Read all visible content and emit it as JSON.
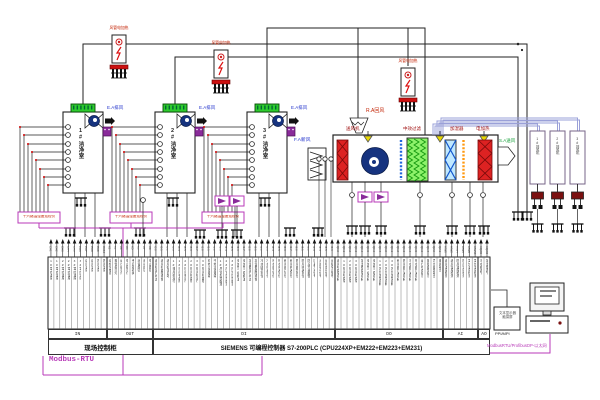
{
  "diagram": {
    "cleanrooms": [
      {
        "name": "1#洁净室",
        "exhaust_label": "E.A排风"
      },
      {
        "name": "2#洁净室",
        "exhaust_label": "E.A排风"
      },
      {
        "name": "3#洁净室",
        "exhaust_label": "E.A排风"
      }
    ],
    "duct_heaters": {
      "label": "风管电加热"
    },
    "ahu": {
      "return_air": "R.A回风",
      "fresh_air": "F.A新风",
      "supply_fan": "送风机",
      "filter": "中效过滤",
      "humidifier": "加湿器",
      "electric_heater": "电加热",
      "supply_air": "S.A送风"
    },
    "exhaust_fans": [
      {
        "name": "1#排风机"
      },
      {
        "name": "2#排风机"
      },
      {
        "name": "3#排风机"
      }
    ],
    "monitors": {
      "label": "十六路温湿度巡检仪"
    },
    "hmi": {
      "line1": "文本显示器",
      "line2": "触摸屏",
      "port_label": "PPI/MPI"
    },
    "buses": {
      "modbus": "Modbus-RTU",
      "ethernet": "ModbusRTU/ProfibusDP-以太网"
    },
    "plc": {
      "cabinet": "现场控制柜",
      "controller": "SIEMENS   可编程控制器 S7-200PLC (CPU224XP+EM222+EM223+EM231)"
    },
    "io_sections": [
      {
        "label": "IN",
        "codes": [
          "CH1",
          "CH2",
          "CH3",
          "CH4",
          "CH5",
          "CH6",
          "CH7",
          "CH8",
          "CH9",
          "CH10"
        ],
        "signals": [
          "1#室内温度",
          "1#室内湿度",
          "2#室内温度",
          "2#室内湿度",
          "3#室内温度",
          "3#室内湿度",
          "送风温度",
          "送风湿度",
          "回风温度",
          "回风湿度"
        ]
      },
      {
        "label": "OUT",
        "codes": [
          "K1",
          "K2",
          "K3",
          "K4",
          "K5",
          "K6",
          "K7",
          "K8"
        ],
        "signals": [
          "巡检仪电源",
          "报警指示灯",
          "运行指示灯",
          "停止指示灯",
          "手自动转换",
          "消音按钮",
          "启动按钮",
          "停止按钮"
        ]
      },
      {
        "label": "DI",
        "codes": [
          "I0.0",
          "I0.1",
          "I0.2",
          "I0.3",
          "I0.4",
          "I0.5",
          "I0.6",
          "I0.7",
          "I1.0",
          "I1.1",
          "I1.2",
          "I1.3",
          "I1.4",
          "I1.5",
          "I1.6",
          "I1.7",
          "I2.0",
          "I2.1",
          "I2.2",
          "I2.3",
          "I2.4",
          "I2.5",
          "I2.6",
          "I2.7",
          "I3.0",
          "I3.1",
          "I3.2",
          "I3.3",
          "I3.4",
          "I3.5",
          "I3.6"
        ],
        "signals": [
          "送风机运行状态",
          "送风机故障报警",
          "送风机手自动",
          "1#排风机运行",
          "1#排风机故障",
          "2#排风机运行",
          "2#排风机故障",
          "3#排风机运行",
          "3#排风机故障",
          "初效过滤堵塞",
          "中效过滤堵塞",
          "1#风管加热超温",
          "2#风管加热超温",
          "3#风管加热超温",
          "电加热一级超温",
          "电加热二级超温",
          "加湿器运行状态",
          "加湿器故障报警",
          "冷水阀开到位",
          "冷水阀关到位",
          "热水阀开到位",
          "热水阀关到位",
          "新风阀开到位",
          "新风阀关到位",
          "回风阀开到位",
          "回风阀关到位",
          "防冻开关报警",
          "压差开关信号",
          "消防联动信号",
          "远程启动信号",
          "远程停止信号"
        ]
      },
      {
        "label": "DO",
        "codes": [
          "Q0.0",
          "Q0.1",
          "Q0.2",
          "Q0.3",
          "Q0.4",
          "Q0.5",
          "Q0.6",
          "Q0.7",
          "Q1.0",
          "Q1.1",
          "Q1.2",
          "Q1.3",
          "Q1.4",
          "Q1.5",
          "Q1.6",
          "Q1.7",
          "Q2.0",
          "Q2.1"
        ],
        "signals": [
          "送风机启停控制",
          "1#排风机启停",
          "2#排风机启停",
          "3#排风机启停",
          "加湿器启停控制",
          "电加热一级控制",
          "电加热二级控制",
          "1#风管加热控制",
          "2#风管加热控制",
          "3#风管加热控制",
          "新风阀开关控制",
          "回风阀开关控制",
          "冷水阀开关控制",
          "热水阀开关控制",
          "运行状态指示",
          "故障报警指示",
          "声光报警输出",
          "备用输出"
        ]
      },
      {
        "label": "AI",
        "codes": [
          "AIW0",
          "AIW2",
          "AIW4",
          "AIW6",
          "AIW8",
          "AIW10"
        ],
        "signals": [
          "送风温度检测",
          "送风湿度检测",
          "回风温度检测",
          "回风湿度检测",
          "室外温度检测",
          "室外湿度检测"
        ]
      },
      {
        "label": "AO",
        "codes": [
          "AQW0",
          "AQW2"
        ],
        "signals": [
          "冷水阀调节",
          "加湿量调节"
        ]
      }
    ],
    "colors": {
      "wire": "#222222",
      "modbus": "#b83ab8",
      "bundle": "#9aa0d8",
      "coil_red": "#dd2222",
      "filter_green": "#8df26a",
      "fan_navy": "#16337f",
      "humidifier_blue": "#bfe8ff",
      "terminal_green": "#2ecc2e",
      "heater_orange": "#ff9911",
      "valve_yellow": "#e8d800"
    }
  }
}
